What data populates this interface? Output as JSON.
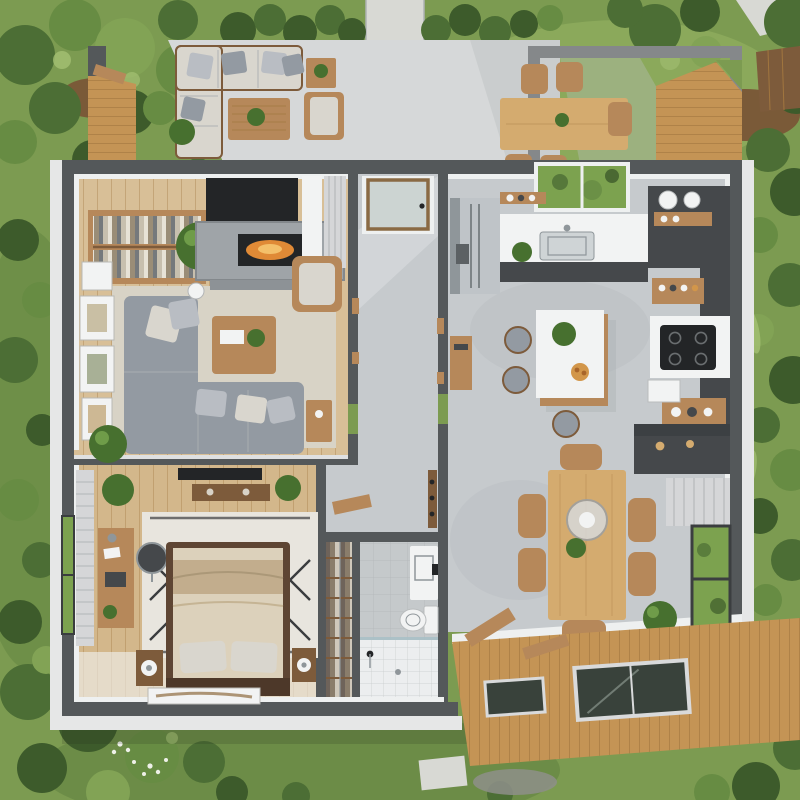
{
  "scene": {
    "type": "3d-floor-plan-render",
    "description": "Top-down photorealistic 3D render of a one-bedroom house: outdoor lounge patio and dining terrace at top, living room with fireplace, bedroom, closet and bathroom on the left, open kitchen with island and dining area on the right, wooden deck with glass skylights at bottom-right, lawn, trees and stone paths all around.",
    "rooms_visible": [
      "outdoor-lounge-patio",
      "outdoor-dining-terrace",
      "living-room",
      "hallway-entry",
      "kitchen",
      "bedroom",
      "closet",
      "bathroom",
      "dining-area",
      "wood-deck",
      "garden"
    ],
    "text_content": "none - image contains no rendered text"
  },
  "palette": {
    "grass": "#7c9b51",
    "grassDark": "#5e803f",
    "grassLight": "#91af60",
    "tree1": "#3d5b2b",
    "tree2": "#4c6e35",
    "tree3": "#678c43",
    "tree4": "#82a355",
    "treeLight": "#a4c073",
    "dirt": "#7a5a38",
    "path": "#d8d9d4",
    "slab": "#d6d8d9",
    "slabShade": "#bcc0c2",
    "wall": "#54585a",
    "beam": "#85888a",
    "innerWall": "#eef0f0",
    "whiteBand": "#e6e7e7",
    "woodFurn": "#b6885a",
    "woodDark": "#7d5b3b",
    "woodTable": "#d4ab6f",
    "woodFloor": "#d8bf97",
    "bedFloor": "#d3b78b",
    "concrete": "#c6cacd",
    "concreteDark": "#aeb3b6",
    "deck": "#c49455",
    "deckLine": "#a1763f",
    "rug": "#d8d3c6",
    "rugBed": "#e8e5de",
    "rugLine": "#3a3c3e",
    "sofa": "#939aa2",
    "sofaLight": "#b9bdc3",
    "cushion": "#d9d6ce",
    "white": "#f2f3f3",
    "black": "#232527",
    "charcoal": "#45484b",
    "steel": "#bfc4c8",
    "steelDark": "#8f969a",
    "stone": "#9fa4a8",
    "fire": "#e08a36",
    "plant": "#47702f",
    "plantLight": "#6f9c49",
    "bedFrame": "#5e4533",
    "bedding": "#dcd1bb",
    "beddingDark": "#c2ad8d",
    "curtain": "#d5d6d8",
    "glass": "#39423b",
    "glassSky": "#7ca24f",
    "tile": "#c5c9cb",
    "tileWhite": "#eceeef",
    "orange": "#d2964a",
    "gridLine": "#aeb2b4",
    "shadow": "#20261a"
  }
}
